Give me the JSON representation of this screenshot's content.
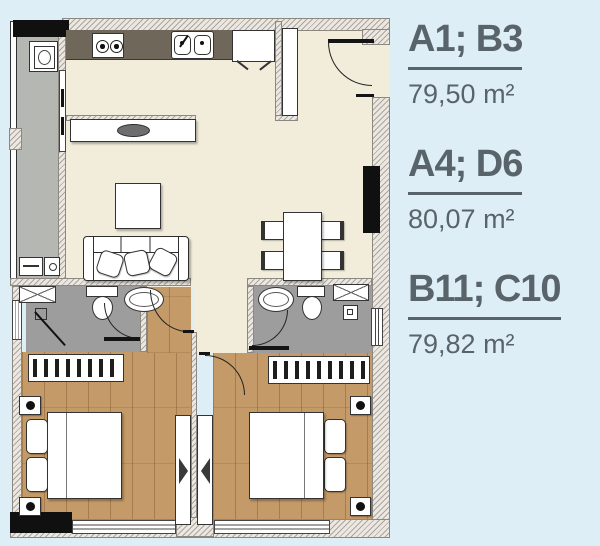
{
  "legend": {
    "units": [
      {
        "code": "A1; B3",
        "area": "79,50 m²"
      },
      {
        "code": "A4; D6",
        "area": "80,07 m²"
      },
      {
        "code": "B11; C10",
        "area": "79,82 m²"
      }
    ]
  },
  "palette": {
    "background": "#ddeef6",
    "legend_text": "#59646a",
    "floor_main": "#f2eddb",
    "floor_wood": "#c49a68",
    "floor_bathroom": "#9d9d9d",
    "floor_balcony": "#b5b7b2",
    "kitchen_counter": "#6f675a",
    "structural_column": "#101010"
  },
  "floorplan_icons": [
    "stove-icon",
    "kitchen-sink-icon",
    "fridge-icon",
    "kitchen-island-icon",
    "sofa-icon",
    "coffee-table-icon",
    "dining-table-icon",
    "chair-icon",
    "toilet-icon",
    "washbasin-icon",
    "shower-icon",
    "wardrobe-icon",
    "bed-icon",
    "nightstand-lamp-icon",
    "tv-unit-icon",
    "washing-machine-icon",
    "door-swing-icon",
    "window-icon"
  ]
}
